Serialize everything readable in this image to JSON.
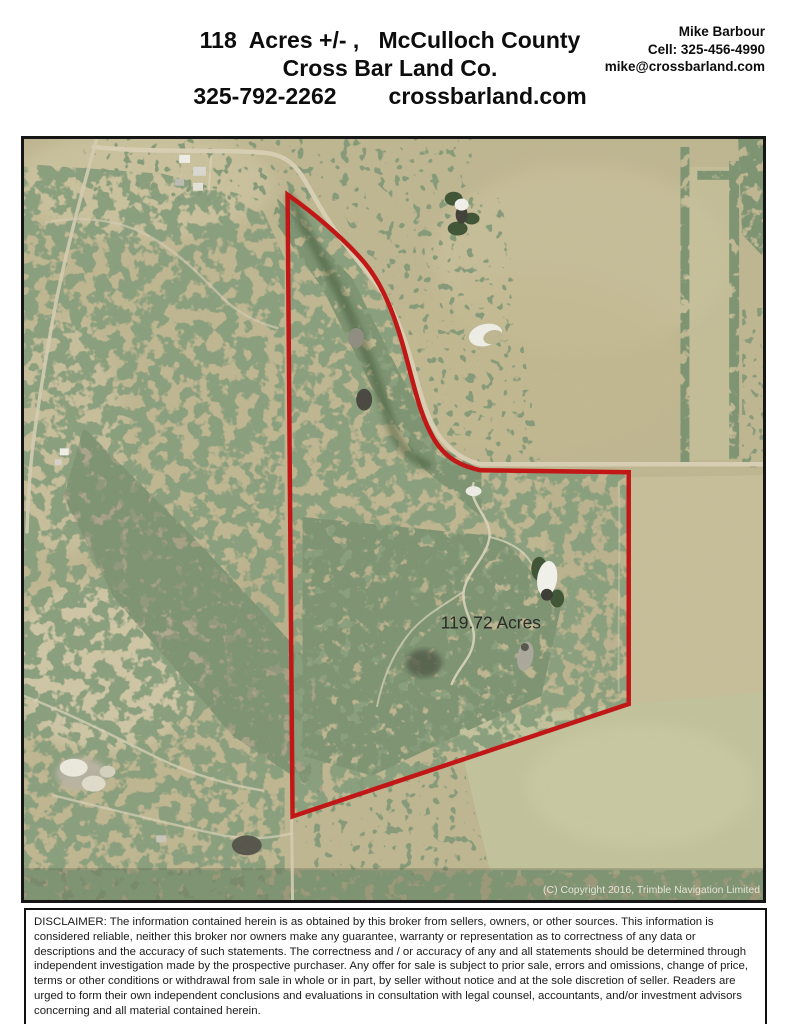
{
  "header": {
    "line1": "118  Acres +/- ,   McCulloch County",
    "line2": "Cross Bar Land Co.",
    "line3_phone": "325-792-2262",
    "line3_site": "crossbarland.com",
    "contact": {
      "name": "Mike Barbour",
      "cell": "Cell: 325-456-4990",
      "email": "mike@crossbarland.com"
    }
  },
  "map": {
    "acreage_label": "119.72 Acres",
    "copyright": "(C) Copyright 2016, Trimble Navigation Limited",
    "boundary_color": "#c21717"
  },
  "disclaimer_text": "DISCLAIMER: The information contained herein is as obtained by this broker from sellers, owners, or other sources. This information is considered reliable, neither this broker nor owners make any guarantee, warranty or representation as to correctness of any data or descriptions and the accuracy of such statements. The correctness and / or accuracy of any and all statements should be determined through independent investigation made by the prospective purchaser. Any offer for sale is subject to prior sale, errors and omissions, change of price, terms or other conditions or withdrawal from sale in whole or in part, by seller without notice and at the sole discretion of seller. Readers are urged to form their own independent conclusions and evaluations in consultation with legal counsel, accountants, and/or investment advisors concerning and all material contained herein."
}
